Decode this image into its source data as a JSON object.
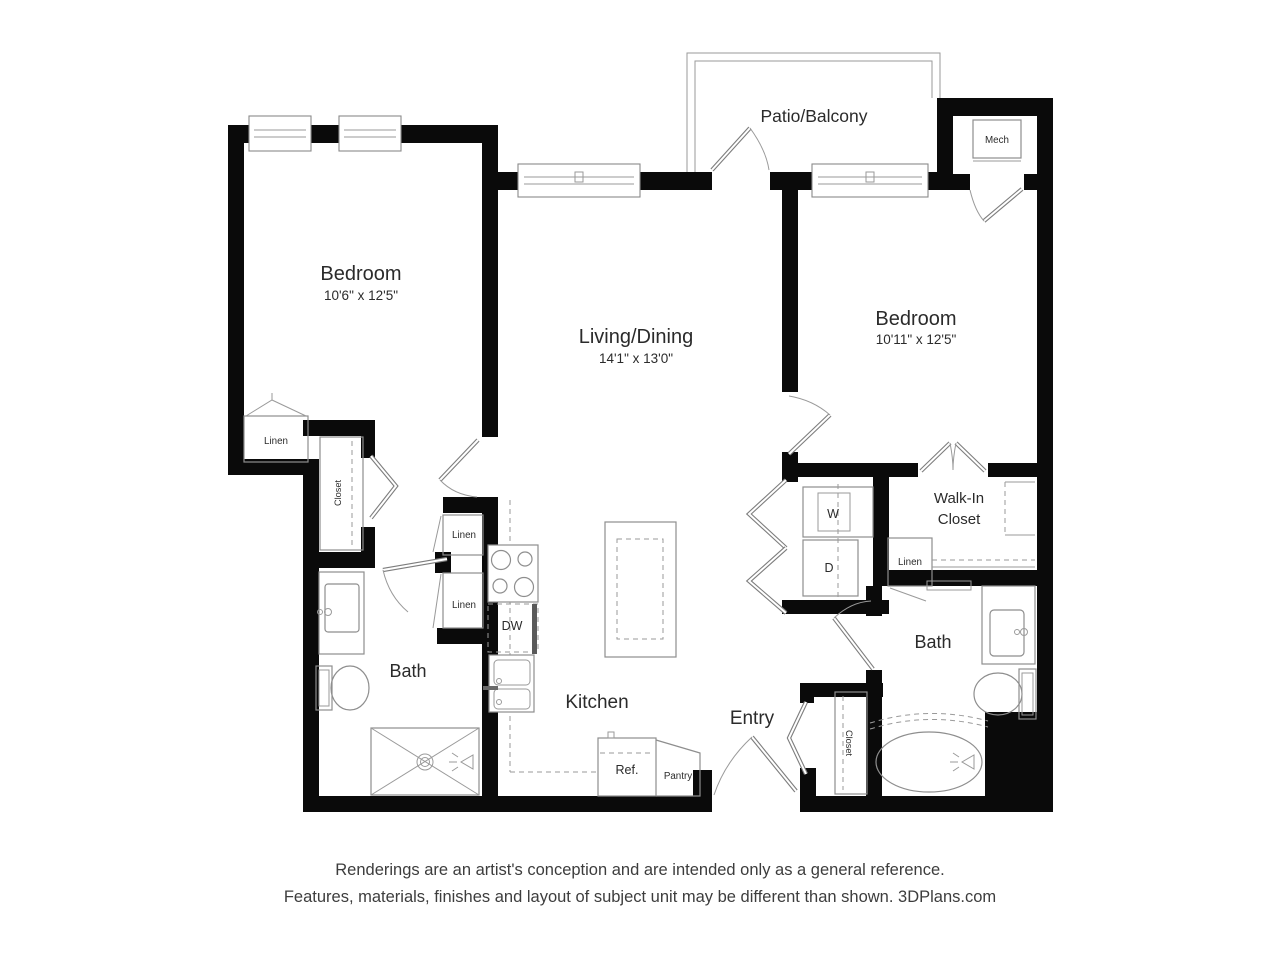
{
  "plan": {
    "colors": {
      "wall": "#0a0a0a",
      "fixture_line": "#8e8e8e",
      "label_text": "#2b2b2b"
    },
    "rooms": {
      "patio": {
        "label": "Patio/Balcony"
      },
      "bedroom1": {
        "label": "Bedroom",
        "dims": "10'6\" x 12'5\""
      },
      "bedroom2": {
        "label": "Bedroom",
        "dims": "10'11\" x 12'5\""
      },
      "living": {
        "label": "Living/Dining",
        "dims": "14'1\" x 13'0\""
      },
      "kitchen": {
        "label": "Kitchen"
      },
      "bath1": {
        "label": "Bath"
      },
      "bath2": {
        "label": "Bath"
      },
      "entry": {
        "label": "Entry"
      },
      "walkin": {
        "line1": "Walk-In",
        "line2": "Closet"
      },
      "mech": {
        "label": "Mech"
      }
    },
    "closets": {
      "bedroom1_linen": "Linen",
      "hall_closet": "Closet",
      "hall_linen_upper": "Linen",
      "hall_linen_lower": "Linen",
      "laundry_linen": "Linen",
      "entry_closet": "Closet"
    },
    "appliances": {
      "washer": "W",
      "dryer": "D",
      "dishwasher": "DW",
      "refrigerator": "Ref.",
      "pantry": "Pantry"
    }
  },
  "footer": {
    "line1": "Renderings are an artist's conception and are intended only as a general reference.",
    "line2": "Features, materials, finishes and layout of subject unit may be different than shown. 3DPlans.com"
  }
}
